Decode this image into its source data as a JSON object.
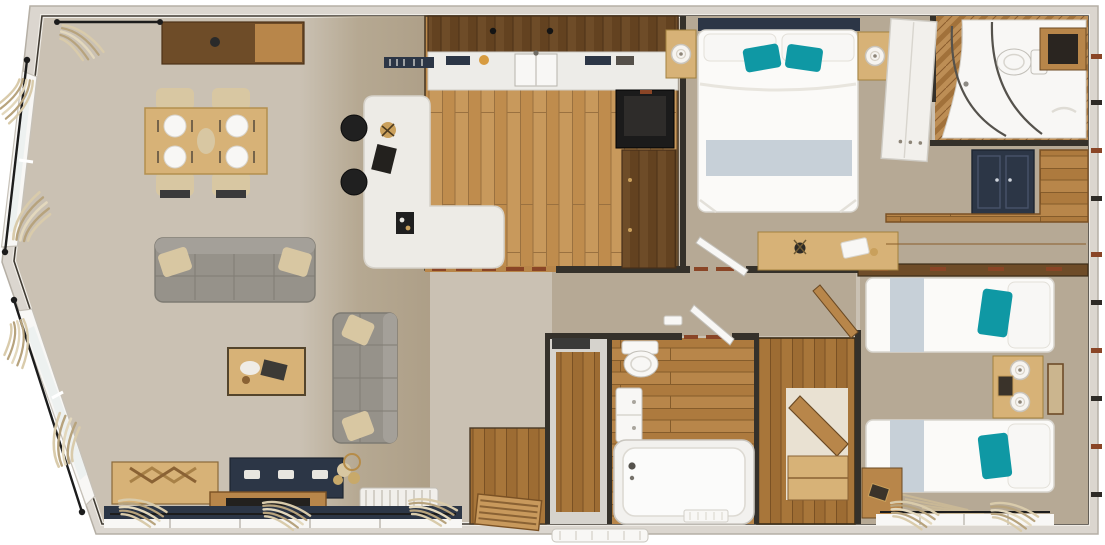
{
  "scene": {
    "type": "holiday-lodge-floor-plan-top-view",
    "style": "photorealistic 3d dollhouse render, no text labels",
    "orientation": "landscape"
  },
  "palette": {
    "shellWall": "#dbd6cf",
    "wallLine": "#35312a",
    "carpetLiving": "#cac1b3",
    "carpetBedroom": "#b6a995",
    "woodFloorLight": "#c8995c",
    "woodMid": "#b8864a",
    "woodDark": "#6e4c28",
    "woodFurniture": "#d7b277",
    "islandWhite": "#edebe6",
    "fixtureWhite": "#f8f7f5",
    "sofaGrey": "#96928a",
    "cushionBeige": "#d8c7a2",
    "teal": "#0f98a4",
    "navy": "#2c3646",
    "runnerGrey": "#c7d0d8",
    "windowGlass": "#edf1f0",
    "thresholdRed": "#8a4526",
    "applianceBlack": "#1b1b1b",
    "curtainTan": "#c9b896"
  },
  "floorplan": {
    "rooms": [
      {
        "name": "open-plan-living-dining",
        "floor": "carpet",
        "furniture": [
          "sideboard",
          "curtain-rail",
          "dining-table",
          "dining-chairs-x4",
          "place-settings-x4",
          "large-sofa",
          "small-sofa",
          "coffee-table",
          "chevron-tv-cabinet",
          "navy-media-unit",
          "storage-bench",
          "pampas-decor",
          "radiator",
          "bay-windows-with-curtains"
        ]
      },
      {
        "name": "kitchen",
        "floor": "oak-planks",
        "furniture": [
          "wall-cabinets",
          "worktop-with-sink",
          "l-shaped-island",
          "bar-stools-x2",
          "tall-black-appliance",
          "base-cabinets",
          "decor-bowl"
        ]
      },
      {
        "name": "entrance-hall",
        "floor": "oak-planks",
        "furniture": [
          "front-door",
          "external-step"
        ]
      },
      {
        "name": "hallway",
        "floor": "carpet",
        "furniture": [
          "door-thresholds"
        ]
      },
      {
        "name": "family-bathroom",
        "floor": "oak-planks",
        "furniture": [
          "bath",
          "toilet",
          "vanity-basin",
          "bath-mat"
        ]
      },
      {
        "name": "airing-cupboard",
        "floor": "oak-planks",
        "furniture": [
          "open-wood-door",
          "shelf"
        ]
      },
      {
        "name": "utility-cupboard",
        "floor": "oak-planks",
        "furniture": []
      },
      {
        "name": "master-bedroom",
        "floor": "carpet",
        "furniture": [
          "double-bed",
          "teal-pillows-x2",
          "headboard",
          "bedside-tables-x2",
          "table-lamps-x2",
          "white-wardrobe",
          "dressing-table",
          "open-door"
        ]
      },
      {
        "name": "en-suite-shower-room",
        "floor": "herringbone-oak",
        "furniture": [
          "curved-shower-enclosure",
          "toilet",
          "shelf-niche",
          "skylight"
        ]
      },
      {
        "name": "dressing-area",
        "floor": "carpet",
        "furniture": [
          "corner-desk",
          "navy-cabinet"
        ]
      },
      {
        "name": "twin-bedroom",
        "floor": "carpet",
        "furniture": [
          "single-bed-x2",
          "teal-pillow-x2",
          "shared-nightstand",
          "table-lamps-x2",
          "picture-frame",
          "corner-desk",
          "window-with-curtains",
          "fringed-throw"
        ]
      }
    ]
  }
}
